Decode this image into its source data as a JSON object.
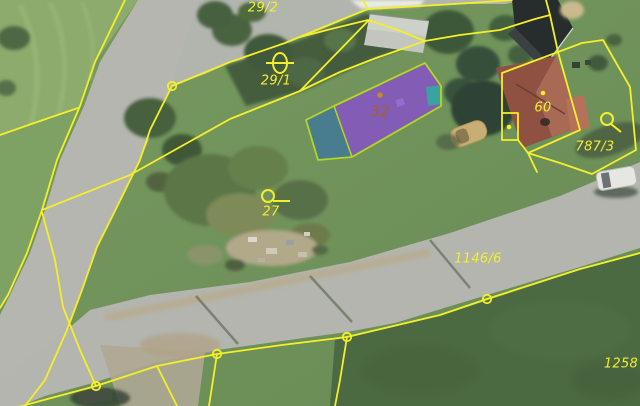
{
  "map": {
    "description": "cadastral-parcel-overlay-on-orthophoto",
    "colors": {
      "cadastral_line": "#f4ef2a",
      "building_outline": "#b5d622",
      "selected_building_fill": "#8a49d3",
      "selected_pool_fill": "#2f6fb0",
      "teal_annex_fill": "#2fae9f",
      "label_yellow": "#f2ee35",
      "label_building": "#a2622e",
      "roof_dot": "#c8882e"
    },
    "labels": [
      {
        "text": "29/2",
        "x": 263,
        "y": 8,
        "size": 13
      },
      {
        "text": "29/1",
        "x": 276,
        "y": 81,
        "size": 13
      },
      {
        "text": "27",
        "x": 271,
        "y": 212,
        "size": 13
      },
      {
        "text": "32",
        "x": 380,
        "y": 112,
        "size": 15,
        "color": "#a2622e"
      },
      {
        "text": "60",
        "x": 543,
        "y": 108,
        "size": 13
      },
      {
        "text": "787/3",
        "x": 595,
        "y": 147,
        "size": 13
      },
      {
        "text": "1146/6",
        "x": 478,
        "y": 259,
        "size": 13
      },
      {
        "text": "1258",
        "x": 621,
        "y": 364,
        "size": 13
      }
    ],
    "lines": [
      {
        "name": "road-left-edge",
        "points": [
          [
            125,
            0
          ],
          [
            95,
            62
          ],
          [
            80,
            106
          ],
          [
            57,
            160
          ],
          [
            42,
            210
          ],
          [
            27,
            253
          ],
          [
            8,
            295
          ],
          [
            0,
            308
          ]
        ]
      },
      {
        "name": "branch-west",
        "points": [
          [
            78,
            108
          ],
          [
            40,
            121
          ],
          [
            0,
            135
          ]
        ]
      },
      {
        "name": "diagonal-cross",
        "points": [
          [
            42,
            210
          ],
          [
            130,
            175
          ],
          [
            230,
            119
          ],
          [
            300,
            91
          ],
          [
            368,
            21
          ]
        ]
      },
      {
        "name": "diagonal-branch",
        "points": [
          [
            300,
            91
          ],
          [
            340,
            72
          ],
          [
            376,
            58
          ],
          [
            425,
            41
          ]
        ]
      },
      {
        "name": "road-mid",
        "points": [
          [
            42,
            212
          ],
          [
            55,
            260
          ],
          [
            63,
            307
          ],
          [
            80,
            350
          ],
          [
            96,
            386
          ]
        ]
      },
      {
        "name": "road-right-edge",
        "points": [
          [
            172,
            86
          ],
          [
            150,
            130
          ],
          [
            140,
            160
          ],
          [
            113,
            215
          ],
          [
            97,
            247
          ],
          [
            82,
            290
          ],
          [
            67,
            330
          ],
          [
            45,
            380
          ],
          [
            25,
            406
          ]
        ]
      },
      {
        "name": "road-lower-edge",
        "points": [
          [
            172,
            86
          ],
          [
            230,
            62
          ],
          [
            285,
            43
          ],
          [
            353,
            15
          ],
          [
            368,
            9
          ],
          [
            470,
            3
          ],
          [
            512,
            0
          ]
        ]
      },
      {
        "name": "stub-north-a",
        "points": [
          [
            363,
            0
          ],
          [
            368,
            9
          ]
        ]
      },
      {
        "name": "parcel-north",
        "points": [
          [
            300,
            37
          ],
          [
            335,
            28
          ],
          [
            368,
            20
          ],
          [
            395,
            29
          ],
          [
            425,
            41
          ],
          [
            460,
            35
          ],
          [
            500,
            30
          ],
          [
            535,
            19
          ],
          [
            550,
            15
          ],
          [
            558,
            52
          ]
        ]
      },
      {
        "name": "stub-north-b",
        "points": [
          [
            546,
            0
          ],
          [
            550,
            15
          ]
        ]
      },
      {
        "name": "house-60-parcel",
        "points": [
          [
            502,
            73
          ],
          [
            558,
            52
          ],
          [
            580,
            130
          ],
          [
            528,
            153
          ],
          [
            518,
            140
          ],
          [
            518,
            113
          ],
          [
            502,
            113
          ],
          [
            502,
            73
          ]
        ]
      },
      {
        "name": "house-60-notch",
        "points": [
          [
            502,
            113
          ],
          [
            502,
            140
          ],
          [
            518,
            140
          ]
        ]
      },
      {
        "name": "parcel-787-3",
        "points": [
          [
            558,
            52
          ],
          [
            582,
            43
          ],
          [
            603,
            40
          ],
          [
            630,
            87
          ],
          [
            636,
            150
          ],
          [
            592,
            174
          ],
          [
            560,
            163
          ],
          [
            528,
            153
          ]
        ]
      },
      {
        "name": "parcel-787-tail",
        "points": [
          [
            528,
            153
          ],
          [
            537,
            172
          ]
        ]
      },
      {
        "name": "bottom-boundary",
        "points": [
          [
            0,
            412
          ],
          [
            40,
            401
          ],
          [
            96,
            386
          ],
          [
            157,
            366
          ],
          [
            217,
            354
          ],
          [
            282,
            345
          ],
          [
            347,
            337
          ],
          [
            440,
            315
          ],
          [
            487,
            299
          ],
          [
            580,
            269
          ],
          [
            640,
            253
          ]
        ]
      },
      {
        "name": "bottom-branch-1",
        "points": [
          [
            157,
            366
          ],
          [
            177,
            406
          ]
        ]
      },
      {
        "name": "bottom-branch-2",
        "points": [
          [
            217,
            354
          ],
          [
            209,
            406
          ]
        ]
      },
      {
        "name": "bottom-branch-3",
        "points": [
          [
            347,
            337
          ],
          [
            340,
            380
          ],
          [
            335,
            406
          ]
        ]
      }
    ],
    "vertex_circles": [
      [
        172,
        86
      ],
      [
        96,
        386
      ],
      [
        217,
        354
      ],
      [
        347,
        337
      ],
      [
        487,
        299
      ]
    ],
    "point_dots": [
      {
        "x": 543,
        "y": 93
      },
      {
        "x": 509,
        "y": 127
      }
    ],
    "roof_dot": {
      "x": 380,
      "y": 95
    },
    "symbols": {
      "boundary_marker": {
        "cx": 280,
        "cy": 63,
        "rx": 7,
        "ry": 10
      },
      "wells": [
        {
          "cx": 268,
          "cy": 196,
          "r": 6,
          "tail": [
            [
              273,
              201
            ],
            [
              290,
              201
            ]
          ]
        },
        {
          "cx": 607,
          "cy": 119,
          "r": 6,
          "tail": [
            [
              611,
              124
            ],
            [
              621,
              132
            ]
          ]
        }
      ]
    },
    "building_32": {
      "outline": [
        [
          306,
          120
        ],
        [
          334,
          106
        ],
        [
          425,
          63
        ],
        [
          441,
          86
        ],
        [
          441,
          106
        ],
        [
          352,
          157
        ],
        [
          318,
          160
        ]
      ],
      "purple": [
        [
          334,
          106
        ],
        [
          425,
          63
        ],
        [
          441,
          86
        ],
        [
          441,
          106
        ],
        [
          352,
          157
        ]
      ],
      "pool": [
        [
          306,
          120
        ],
        [
          334,
          106
        ],
        [
          352,
          157
        ],
        [
          318,
          160
        ]
      ],
      "teal": [
        [
          426,
          87
        ],
        [
          441,
          85
        ],
        [
          442,
          104
        ],
        [
          428,
          106
        ]
      ],
      "divider": [
        [
          334,
          106
        ],
        [
          352,
          157
        ]
      ]
    }
  }
}
